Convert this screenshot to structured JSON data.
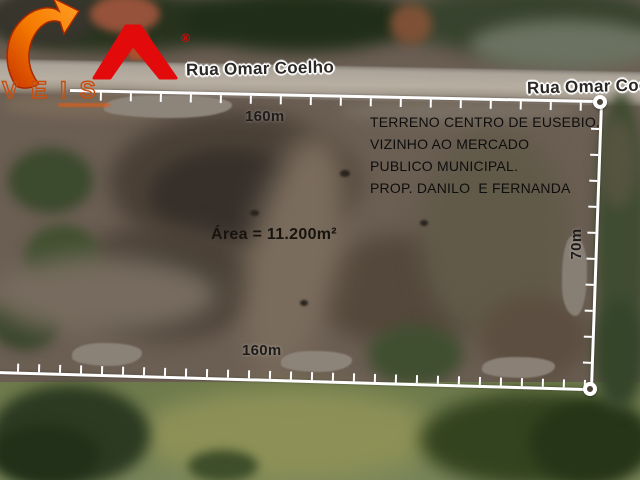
{
  "logo": {
    "wordmark": "VEIS",
    "registered_mark": "®",
    "symbol": "arrow-and-A-monogram",
    "colors": {
      "red": "#e20a0a",
      "orange": "#f07818",
      "outline": "#c84d0e"
    }
  },
  "map": {
    "street_labels": [
      {
        "text": "Rua Omar Coelho"
      },
      {
        "text": "Rua Omar Coe"
      }
    ],
    "annotations": {
      "description_lines": [
        "TERRENO CENTRO DE EUSEBIO.",
        "VIZINHO AO MERCADO",
        "PUBLICO MUNICIPAL.",
        "PROP. DANILO  E FERNANDA"
      ],
      "area_label": "Área = 11.200m²",
      "dimensions": {
        "top": "160m",
        "bottom": "160m",
        "right": "70m"
      }
    },
    "boundary": {
      "stroke_color": "#ffffff",
      "thickness": 2.6,
      "lines": [
        {
          "name": "boundary-top",
          "x": 70,
          "y": 89,
          "length": 532,
          "angle_deg": 1.2,
          "orient": "h",
          "tick_side": "down",
          "tick_spacing": 30,
          "tick_count": 18
        },
        {
          "name": "boundary-bottom",
          "x": -4,
          "y": 371,
          "length": 597,
          "angle_deg": 1.65,
          "orient": "h",
          "tick_side": "up",
          "tick_spacing": 21,
          "tick_count": 29
        },
        {
          "name": "boundary-right",
          "x": 600,
          "y": 102,
          "length": 288,
          "angle_deg": 2.0,
          "orient": "v",
          "tick_side": "left",
          "tick_spacing": 26,
          "tick_count": 11
        }
      ]
    },
    "colors": {
      "boundary": "#ffffff",
      "street_label_text": "#2b2724",
      "annotation_text": "#0e0e0e",
      "smudge_gray": "#8d847a",
      "road_gray": "#aea598"
    }
  }
}
